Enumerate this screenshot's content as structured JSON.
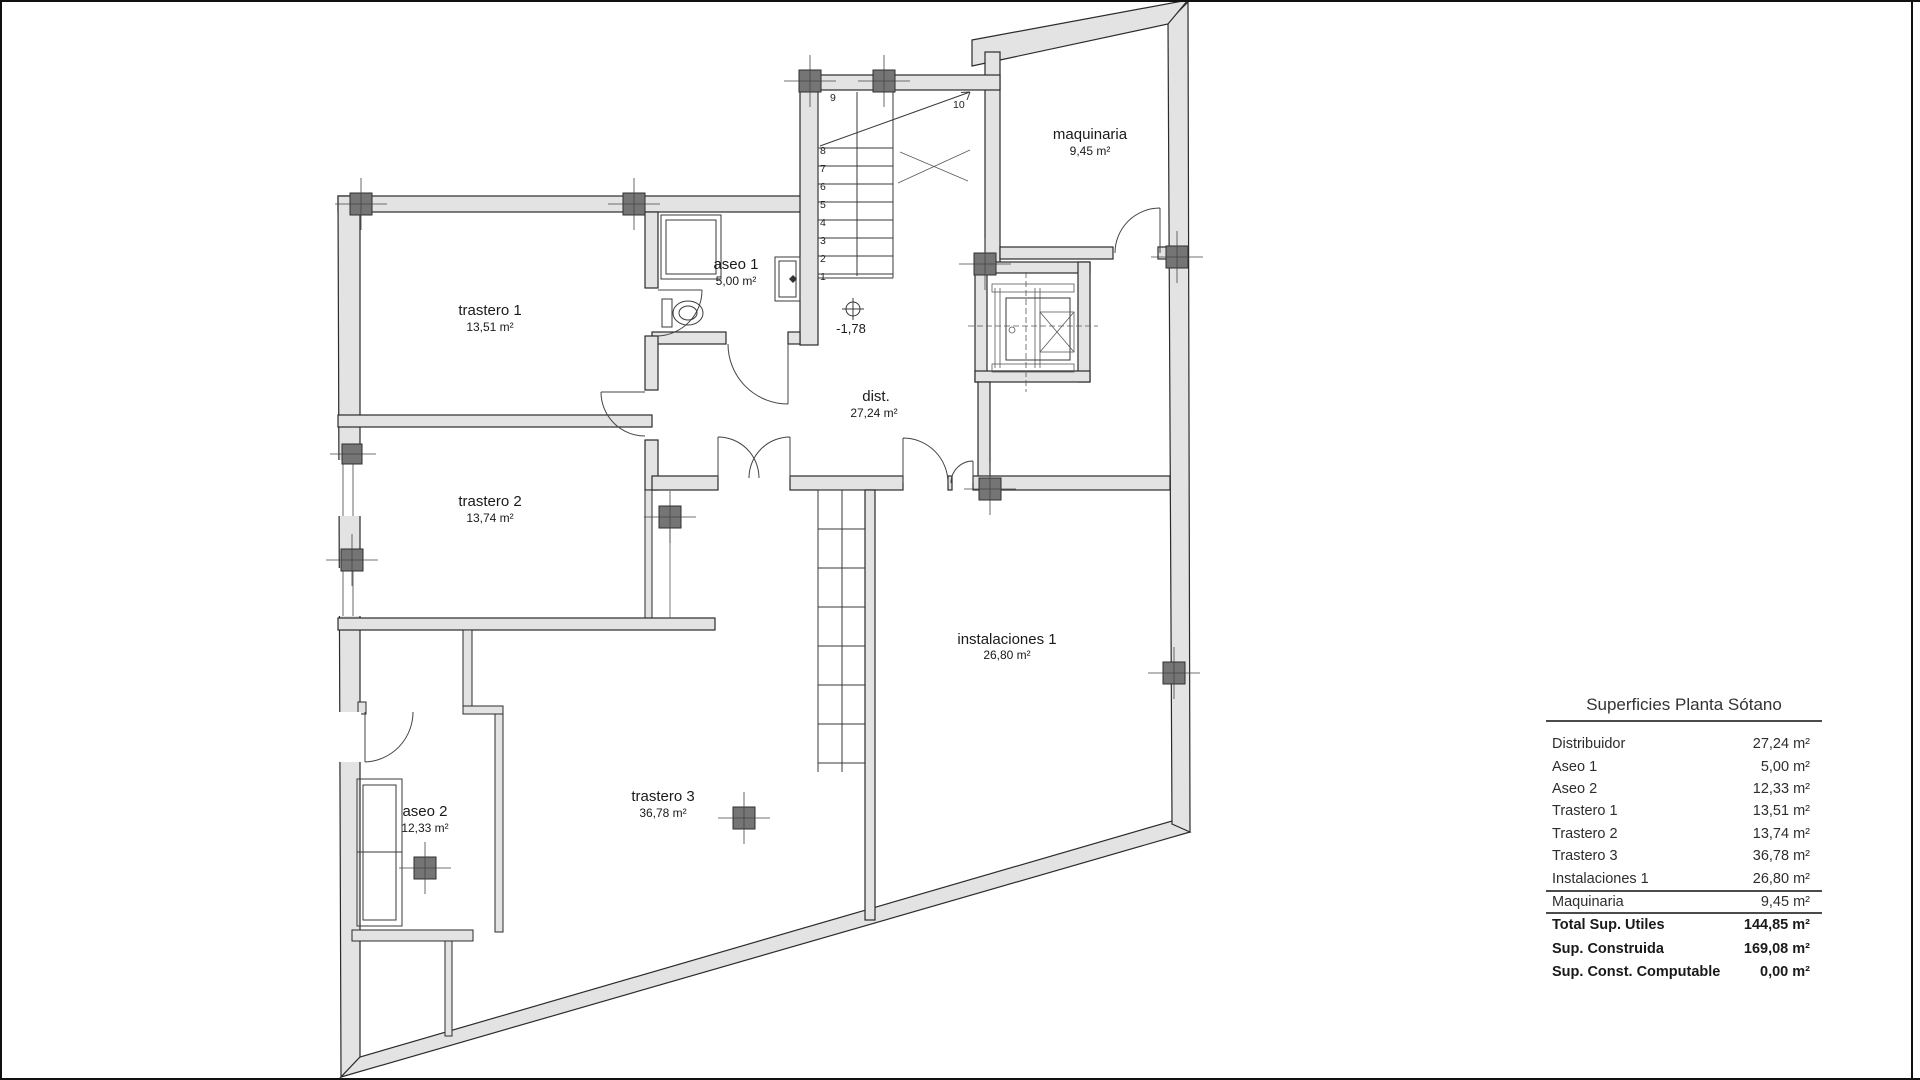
{
  "plan": {
    "rooms": [
      {
        "name": "trastero 1",
        "area": "13,51 m²"
      },
      {
        "name": "trastero 2",
        "area": "13,74 m²"
      },
      {
        "name": "trastero 3",
        "area": "36,78 m²"
      },
      {
        "name": "aseo 1",
        "area": "5,00 m²"
      },
      {
        "name": "aseo 2",
        "area": "12,33 m²"
      },
      {
        "name": "dist.",
        "area": "27,24 m²"
      },
      {
        "name": "instalaciones 1",
        "area": "26,80 m²"
      },
      {
        "name": "maquinaria",
        "area": "9,45 m²"
      }
    ],
    "level_marker": "-1,78",
    "stair_numbers": [
      "1",
      "2",
      "3",
      "4",
      "5",
      "6",
      "7",
      "8",
      "9",
      "10"
    ]
  },
  "summary_table": {
    "title": "Superficies Planta Sótano",
    "rows": [
      {
        "label": "Distribuidor",
        "value": "27,24 m²"
      },
      {
        "label": "Aseo 1",
        "value": "5,00 m²"
      },
      {
        "label": "Aseo 2",
        "value": "12,33 m²"
      },
      {
        "label": "Trastero 1",
        "value": "13,51 m²"
      },
      {
        "label": "Trastero 2",
        "value": "13,74 m²"
      },
      {
        "label": "Trastero 3",
        "value": "36,78 m²"
      },
      {
        "label": "Instalaciones 1",
        "value": "26,80 m²"
      },
      {
        "label": "Maquinaria",
        "value": "9,45 m²"
      }
    ],
    "totals": [
      {
        "label": "Total Sup. Utiles",
        "value": "144,85 m²"
      },
      {
        "label": "Sup. Construida",
        "value": "169,08 m²"
      },
      {
        "label": "Sup. Const. Computable",
        "value": "0,00 m²"
      }
    ]
  },
  "colors": {
    "wall_fill": "#e3e3e3",
    "wall_stroke": "#2b2b2b",
    "column_fill": "#757575",
    "frame": "#111111",
    "text": "#1a1a1a"
  }
}
